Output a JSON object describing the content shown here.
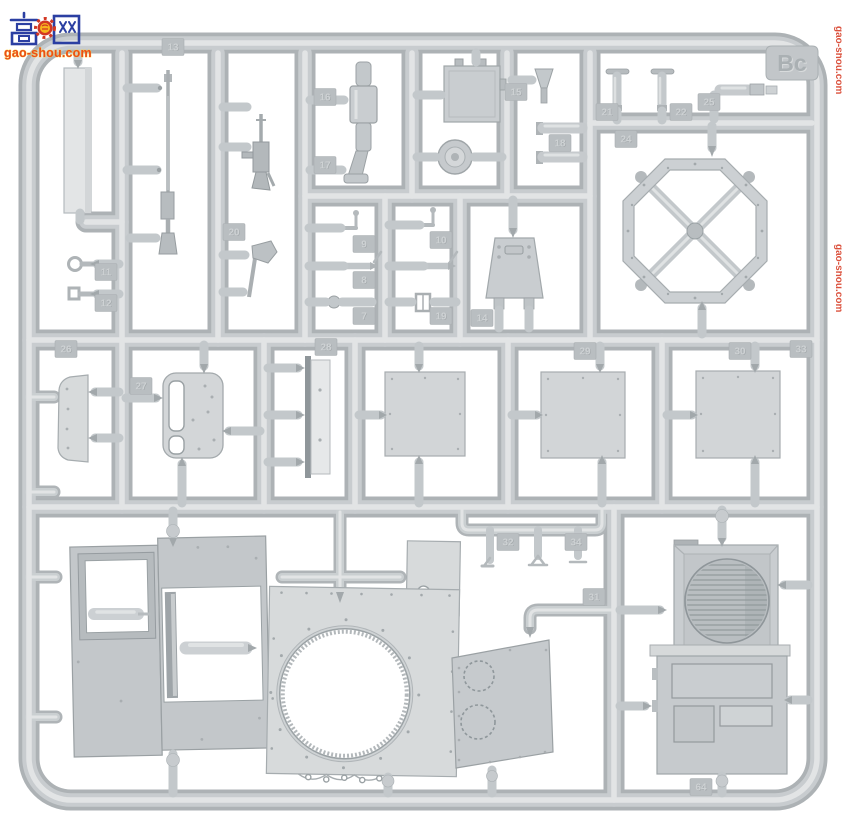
{
  "watermark": {
    "logo_char_left": "高",
    "logo_char_right": "网",
    "logo_icon": "fist-gear-icon",
    "url": "gao-shou.com",
    "side_url": "gao-shou.com",
    "colors": {
      "blue": "#2b3fa2",
      "red": "#d23723",
      "yellow": "#f6b51e",
      "url_fill": "#e94e1b",
      "url_outline": "#ffd24a"
    }
  },
  "sprue": {
    "letter_tag": "Bc",
    "background": "#ffffff",
    "plastic": {
      "dark": "#adb2b5",
      "mid": "#c8cccf",
      "light": "#e2e4e5",
      "part_fill": "#c9cdd0"
    },
    "part_tags": [
      {
        "label": "13",
        "x": 173,
        "y": 47
      },
      {
        "label": "11",
        "x": 106,
        "y": 272
      },
      {
        "label": "12",
        "x": 106,
        "y": 303
      },
      {
        "label": "20",
        "x": 234,
        "y": 232
      },
      {
        "label": "16",
        "x": 325,
        "y": 97
      },
      {
        "label": "17",
        "x": 325,
        "y": 165
      },
      {
        "label": "9",
        "x": 364,
        "y": 244
      },
      {
        "label": "8",
        "x": 364,
        "y": 280
      },
      {
        "label": "7",
        "x": 364,
        "y": 316
      },
      {
        "label": "10",
        "x": 441,
        "y": 240
      },
      {
        "label": "19",
        "x": 441,
        "y": 316
      },
      {
        "label": "14",
        "x": 482,
        "y": 318
      },
      {
        "label": "15",
        "x": 516,
        "y": 92
      },
      {
        "label": "18",
        "x": 560,
        "y": 143
      },
      {
        "label": "21",
        "x": 607,
        "y": 112
      },
      {
        "label": "22",
        "x": 681,
        "y": 112
      },
      {
        "label": "25",
        "x": 709,
        "y": 102
      },
      {
        "label": "24",
        "x": 626,
        "y": 139
      },
      {
        "label": "33",
        "x": 801,
        "y": 349
      },
      {
        "label": "26",
        "x": 66,
        "y": 349
      },
      {
        "label": "27",
        "x": 141,
        "y": 386
      },
      {
        "label": "28",
        "x": 326,
        "y": 347
      },
      {
        "label": "29",
        "x": 585,
        "y": 351
      },
      {
        "label": "30",
        "x": 740,
        "y": 351
      },
      {
        "label": "32",
        "x": 508,
        "y": 542
      },
      {
        "label": "34",
        "x": 576,
        "y": 542
      },
      {
        "label": "31",
        "x": 594,
        "y": 597
      },
      {
        "label": "64",
        "x": 701,
        "y": 787
      }
    ]
  }
}
